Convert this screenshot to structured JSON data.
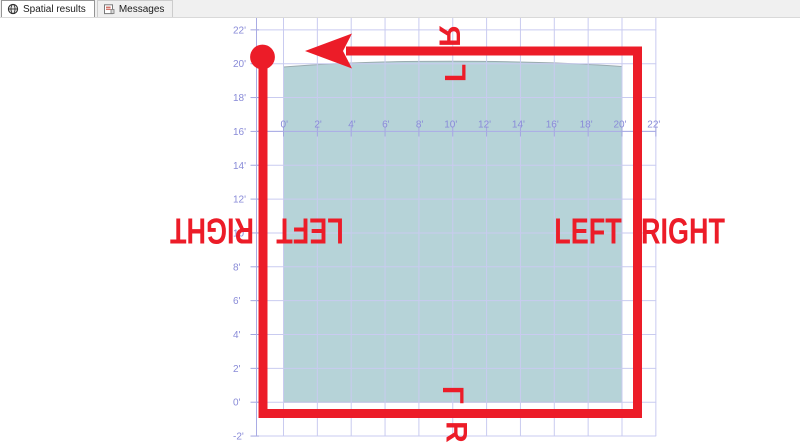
{
  "tabs": [
    {
      "label": "Spatial results",
      "icon": "globe-icon",
      "active": true
    },
    {
      "label": "Messages",
      "icon": "messages-icon",
      "active": false
    }
  ],
  "chart": {
    "type": "spatial-grid",
    "unit": "feet",
    "x_ticks": [
      {
        "ft": 0,
        "label": "0'"
      },
      {
        "ft": 2,
        "label": "2'"
      },
      {
        "ft": 4,
        "label": "4'"
      },
      {
        "ft": 6,
        "label": "6'"
      },
      {
        "ft": 8,
        "label": "8'"
      },
      {
        "ft": 10,
        "label": "10'"
      },
      {
        "ft": 12,
        "label": "12'"
      },
      {
        "ft": 14,
        "label": "14'"
      },
      {
        "ft": 16,
        "label": "16'"
      },
      {
        "ft": 18,
        "label": "18'"
      },
      {
        "ft": 20,
        "label": "20'"
      },
      {
        "ft": 22,
        "label": "22'"
      }
    ],
    "y_ticks": [
      {
        "ft": 22,
        "label": "22'"
      },
      {
        "ft": 20,
        "label": "20'"
      },
      {
        "ft": 18,
        "label": "18'"
      },
      {
        "ft": 16,
        "label": "16'"
      },
      {
        "ft": 14,
        "label": "14'"
      },
      {
        "ft": 12,
        "label": "12'"
      },
      {
        "ft": 10,
        "label": "10'"
      },
      {
        "ft": 8,
        "label": "8'"
      },
      {
        "ft": 6,
        "label": "6'"
      },
      {
        "ft": 4,
        "label": "4'"
      },
      {
        "ft": 2,
        "label": "2'"
      },
      {
        "ft": 0,
        "label": "0'"
      },
      {
        "ft": -2,
        "label": "-2'"
      }
    ],
    "polygon": {
      "type": "polygon",
      "x_range_ft": [
        0,
        20
      ],
      "y_range_ft": [
        0,
        20
      ]
    }
  },
  "annotations": {
    "top_outside": "R",
    "top_inside": "L",
    "bottom_inside": "L",
    "bottom_outside": "R",
    "left_outside": "RIGHT",
    "left_inside": "LEFT",
    "right_inside": "LEFT",
    "right_outside": "RIGHT"
  },
  "colors": {
    "annotation_red": "#ec1c28",
    "polygon_fill": "#b6d3d8",
    "polygon_border": "#9aabaf",
    "grid": "#c9cbf0",
    "axis": "#a9abe4",
    "axis_label": "#898bd8",
    "tabbar_bg": "#f0f0f0"
  }
}
